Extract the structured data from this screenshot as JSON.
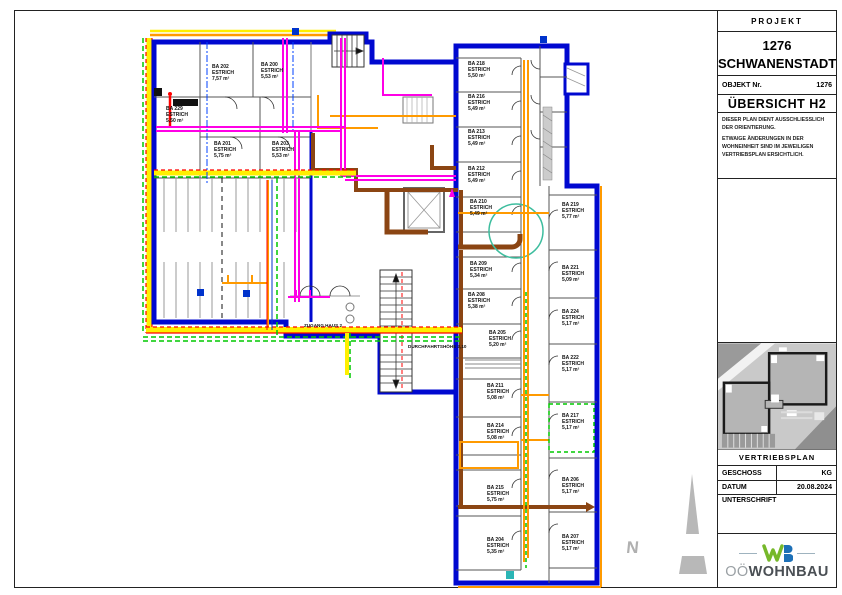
{
  "title_block": {
    "projekt_label": "PROJEKT",
    "project_number": "1276",
    "project_name": "SCHWANENSTADT",
    "objekt_label": "OBJEKT Nr.",
    "objekt_value": "1276",
    "sheet_title": "ÜBERSICHT H2",
    "note_line1": "DIESER PLAN DIENT AUSSCHLIESSLICH DER ORIENTIERUNG.",
    "note_line2": "ETWAIGE ÄNDERUNGEN IN DER WOHNEINHEIT SIND IM JEWEILIGEN VERTRIEBSPLAN ERSICHTLICH.",
    "plan_type_label": "VERTRIEBSPLAN",
    "geschoss_label": "GESCHOSS",
    "geschoss_value": "KG",
    "datum_label": "DATUM",
    "datum_value": "20.08.2024",
    "unterschrift_label": "UNTERSCHRIFT",
    "logo": {
      "prefix": "OÖ",
      "name": "WOHNBAU",
      "green": "#76b82a",
      "blue": "#1d70b7"
    }
  },
  "plan": {
    "north_label": "N",
    "estrich_label": "ESTRICH",
    "annotations": [
      {
        "text": "ZUGANG HAUS 2",
        "x": 304,
        "y": 323
      },
      {
        "text": "DURCHFAHRTSHÖHE 2,10",
        "x": 408,
        "y": 344
      }
    ],
    "rooms": [
      {
        "id": "BA 229",
        "area": "5,50 m²",
        "x": 166,
        "y": 106
      },
      {
        "id": "BA 202",
        "area": "7,57 m²",
        "x": 212,
        "y": 64
      },
      {
        "id": "BA 200",
        "area": "5,53 m²",
        "x": 261,
        "y": 62
      },
      {
        "id": "BA 201",
        "area": "5,75 m²",
        "x": 214,
        "y": 141
      },
      {
        "id": "BA 203",
        "area": "5,53 m²",
        "x": 272,
        "y": 141
      },
      {
        "id": "BA 218",
        "area": "5,50 m²",
        "x": 468,
        "y": 61
      },
      {
        "id": "BA 216",
        "area": "5,49 m²",
        "x": 468,
        "y": 94
      },
      {
        "id": "BA 213",
        "area": "5,49 m²",
        "x": 468,
        "y": 129
      },
      {
        "id": "BA 212",
        "area": "5,49 m²",
        "x": 468,
        "y": 166
      },
      {
        "id": "BA 210",
        "area": "5,49 m²",
        "x": 470,
        "y": 199
      },
      {
        "id": "BA 209",
        "area": "5,34 m²",
        "x": 470,
        "y": 261
      },
      {
        "id": "BA 208",
        "area": "5,38 m²",
        "x": 468,
        "y": 292
      },
      {
        "id": "BA 205",
        "area": "5,20 m²",
        "x": 489,
        "y": 330
      },
      {
        "id": "BA 211",
        "area": "5,08 m²",
        "x": 487,
        "y": 383
      },
      {
        "id": "BA 214",
        "area": "5,08 m²",
        "x": 487,
        "y": 423
      },
      {
        "id": "BA 215",
        "area": "5,75 m²",
        "x": 487,
        "y": 485
      },
      {
        "id": "BA 204",
        "area": "5,35 m²",
        "x": 487,
        "y": 537
      },
      {
        "id": "BA 219",
        "area": "5,77 m²",
        "x": 562,
        "y": 202
      },
      {
        "id": "BA 221",
        "area": "5,09 m²",
        "x": 562,
        "y": 265
      },
      {
        "id": "BA 224",
        "area": "5,17 m²",
        "x": 562,
        "y": 309
      },
      {
        "id": "BA 222",
        "area": "5,17 m²",
        "x": 562,
        "y": 355
      },
      {
        "id": "BA 217",
        "area": "5,17 m²",
        "x": 562,
        "y": 413,
        "hl": true
      },
      {
        "id": "BA 206",
        "area": "5,17 m²",
        "x": 562,
        "y": 477
      },
      {
        "id": "BA 207",
        "area": "5,17 m²",
        "x": 562,
        "y": 534
      }
    ],
    "colors": {
      "wall": "#0008d0",
      "heating": "#ff00e6",
      "water": "#ff9a00",
      "sewer": "#8b4513",
      "marking_yellow": "#ffef00",
      "marking_red": "#ff0000",
      "marking_green": "#00c800",
      "teal": "#3dbd9e"
    }
  }
}
